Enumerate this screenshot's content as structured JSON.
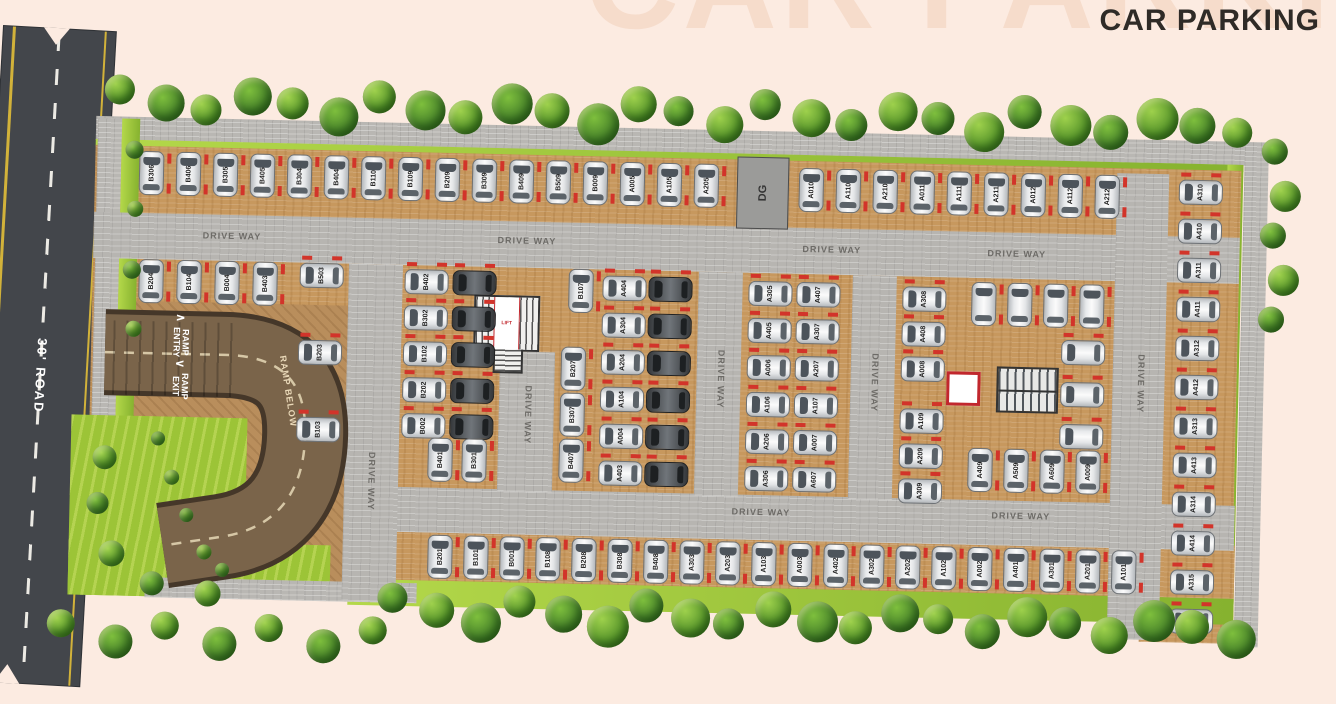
{
  "watermark": "CAR PARKING",
  "title": "CAR PARKING",
  "road": {
    "label": "30' ROAD"
  },
  "ramp": {
    "entry_line1": "RAMP",
    "entry_line2": "ENTRY",
    "exit_line1": "RAMP",
    "exit_line2": "EXIT",
    "below": "RAMP BELOW",
    "entry_arrow": "∧",
    "exit_arrow": "∨"
  },
  "labels": {
    "driveway": "DRIVE WAY",
    "dg": "DG",
    "lift": "LIFT"
  },
  "colors": {
    "background": "#fcebe1",
    "watermark": "#f6dccb",
    "title_text": "#2f2b27",
    "road_asphalt": "#43464b",
    "road_yellow_line": "#d2b23a",
    "driveway_gray": "#b7b5b1",
    "parking_tan": "#c7985e",
    "ramp_brown": "#7a644a",
    "grass_green": "#9cc437",
    "tree_green": "#4e8f27",
    "slot_marker_red": "#d2342a"
  },
  "slots": {
    "top_row_b": [
      "B306",
      "B406",
      "B305",
      "B405",
      "B304",
      "B404",
      "B110",
      "B109",
      "B209",
      "B309",
      "B409",
      "B509",
      "B009",
      "A005",
      "A105",
      "A205"
    ],
    "top_row_a": [
      "A010",
      "A110",
      "A210",
      "A011",
      "A111",
      "A211",
      "A012",
      "A112",
      "A212"
    ],
    "right_col": [
      "A310",
      "A410",
      "A311",
      "A411",
      "A312",
      "A412",
      "A313",
      "A413",
      "A314",
      "A414",
      "A315",
      "A415"
    ],
    "row2_left": [
      "B204",
      "B104",
      "B004",
      "B403"
    ],
    "ramp_col": [
      "B503",
      "B203",
      "B103"
    ],
    "lblock_pairs": [
      "B402",
      "*",
      "B302",
      "*",
      "B102",
      "*",
      "B202",
      "*",
      "B002",
      "*"
    ],
    "lblock_vpair": [
      "B401",
      "B301"
    ],
    "b107": [
      "B107"
    ],
    "lblock_vcol": [
      "B207",
      "B307",
      "B407"
    ],
    "lblock_acol": [
      "A404",
      "*",
      "A304",
      "*",
      "A204",
      "*",
      "A104",
      "*",
      "A004",
      "*",
      "A403",
      "*"
    ],
    "mid_block": [
      "A305",
      "A407",
      "A405",
      "A307",
      "A006",
      "A207",
      "A106",
      "A107",
      "A206",
      "A007",
      "A306",
      "A607"
    ],
    "rmid_col_top": [
      "A308",
      "A408",
      "A008"
    ],
    "rmid_col_bot": [
      "A109",
      "A209",
      "A309"
    ],
    "rmid_top": [
      "",
      "",
      "",
      ""
    ],
    "rmid_right": [
      "",
      "",
      ""
    ],
    "rmid_bottom": [
      "A409",
      "A509",
      "A609",
      "A009"
    ],
    "bottom_row": [
      "B201",
      "B101",
      "B001",
      "B108",
      "B208",
      "B308",
      "B408",
      "A303",
      "A203",
      "A103",
      "A003",
      "A402",
      "A302",
      "A202",
      "A102",
      "A002",
      "A401",
      "A301",
      "A201",
      "A101"
    ]
  }
}
